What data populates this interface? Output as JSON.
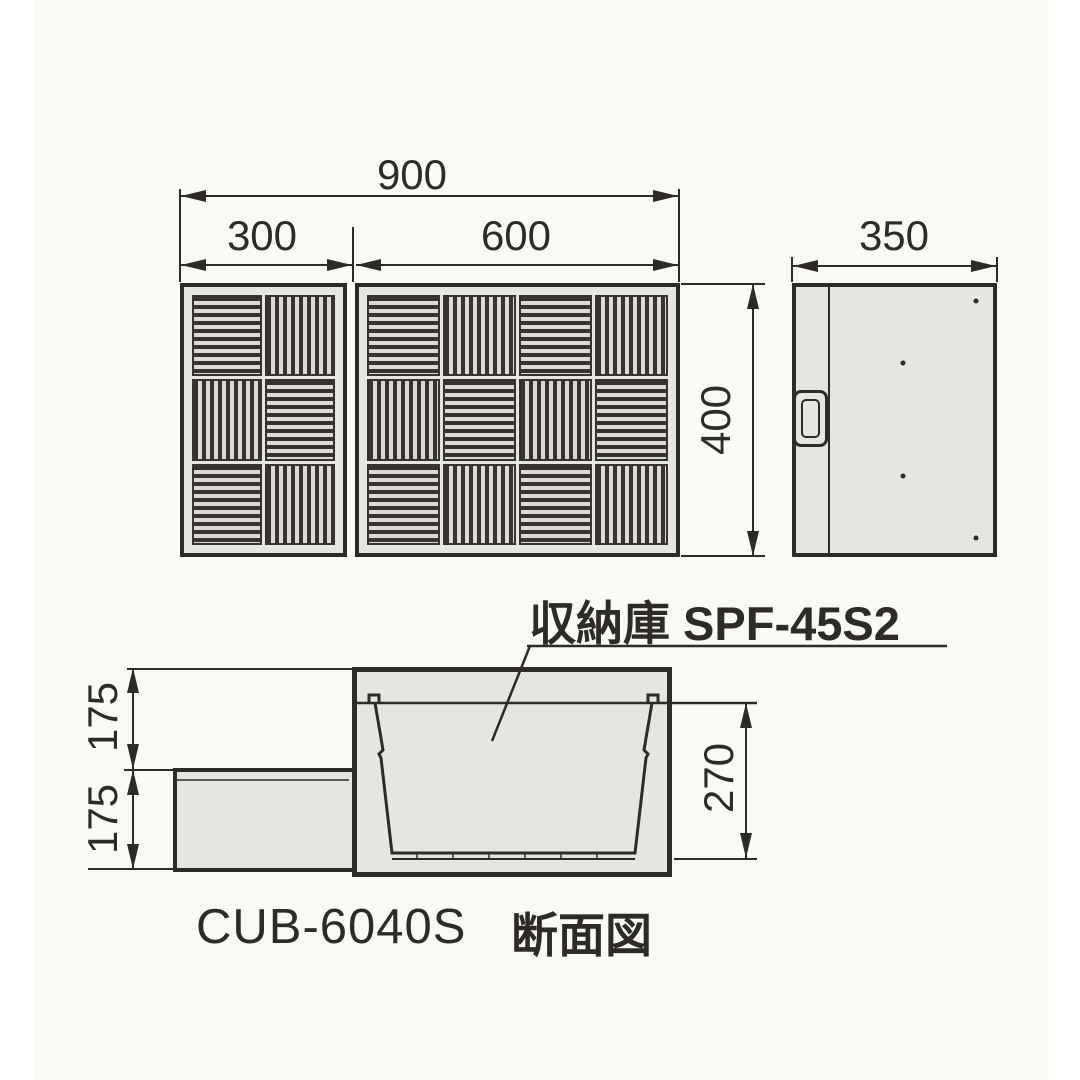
{
  "drawing": {
    "product_model": "CUB-6040S",
    "view_label": "断面図",
    "storage_label": "収納庫 SPF-45S2"
  },
  "top_view": {
    "dim_total_width": "900",
    "dim_left_panel_width": "300",
    "dim_right_panel_width": "600",
    "dim_depth": "400",
    "left_panel_tiles": [
      [
        "H",
        "V"
      ],
      [
        "V",
        "H"
      ],
      [
        "H",
        "V"
      ]
    ],
    "right_panel_tiles": [
      [
        "H",
        "V",
        "H",
        "V"
      ],
      [
        "V",
        "H",
        "V",
        "H"
      ],
      [
        "H",
        "V",
        "H",
        "V"
      ]
    ]
  },
  "side_view": {
    "dim_width": "350"
  },
  "section_view": {
    "dim_upper_height": "175",
    "dim_lower_height": "175",
    "dim_bin_depth": "270"
  },
  "colors": {
    "line": "#2e2a26",
    "panel_fill": "#e5e5e2",
    "slat_dark": "#38332d",
    "slat_light": "#dbdad7",
    "background": "#f8faf3",
    "margin": "#ffffff"
  }
}
